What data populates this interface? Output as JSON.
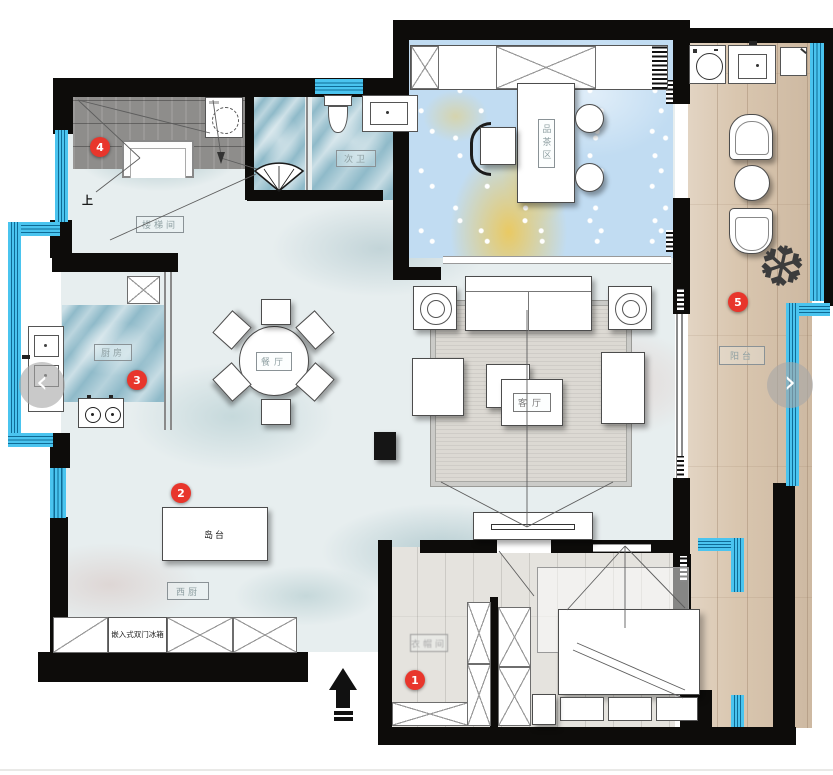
{
  "plan": {
    "labels": {
      "stairwell": "楼梯间",
      "up": "上",
      "bath2": "次卫",
      "tea_area": "品茶区",
      "dining": "餐厅",
      "living": "客厅",
      "kitchen": "厨房",
      "island": "岛台",
      "west_kitchen": "西厨",
      "fridge": "嵌入式双门冰箱",
      "balcony": "阳台",
      "closet": "衣帽间"
    },
    "markers": [
      {
        "num": "1"
      },
      {
        "num": "2"
      },
      {
        "num": "3"
      },
      {
        "num": "4"
      },
      {
        "num": "5"
      }
    ],
    "nav": {
      "prev": "‹",
      "next": "›"
    },
    "colors": {
      "wall": "#0d0c0a",
      "window": "#4ac4ef",
      "marker": "#e8362c",
      "balcony_wood": "#d9c6af",
      "tea_floor": "#c1dcf2",
      "wet_floor": "#8fbac9"
    }
  }
}
